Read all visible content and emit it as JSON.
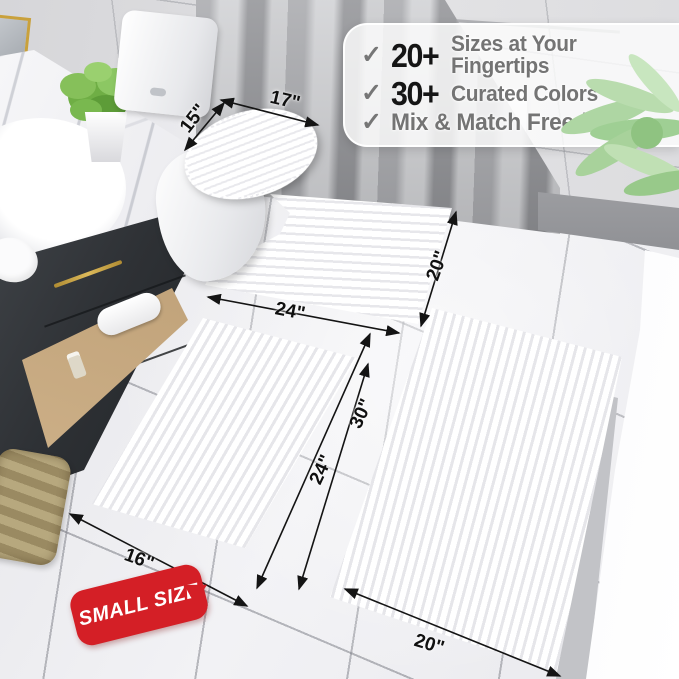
{
  "callout": {
    "items": [
      {
        "check": "✓",
        "stat": "20+",
        "label": "Sizes at Your Fingertips"
      },
      {
        "check": "✓",
        "stat": "30+",
        "label": "Curated Colors"
      },
      {
        "check": "✓",
        "stat": "",
        "label": "Mix & Match Freedom"
      }
    ]
  },
  "measurements": {
    "lid_width": "17\"",
    "lid_depth": "15\"",
    "contour_width": "24\"",
    "contour_depth": "20\"",
    "small_width": "16\"",
    "small_length": "24\"",
    "large_width": "20\"",
    "large_length": "30\""
  },
  "badge": {
    "label": "SMALL SIZE"
  },
  "colors": {
    "badge_red": "#d41f26",
    "stat_black": "#151515",
    "feature_gray": "#747474",
    "check_gray": "#767676",
    "gold_accent": "#c9a13c",
    "dimension_black": "#101010"
  }
}
